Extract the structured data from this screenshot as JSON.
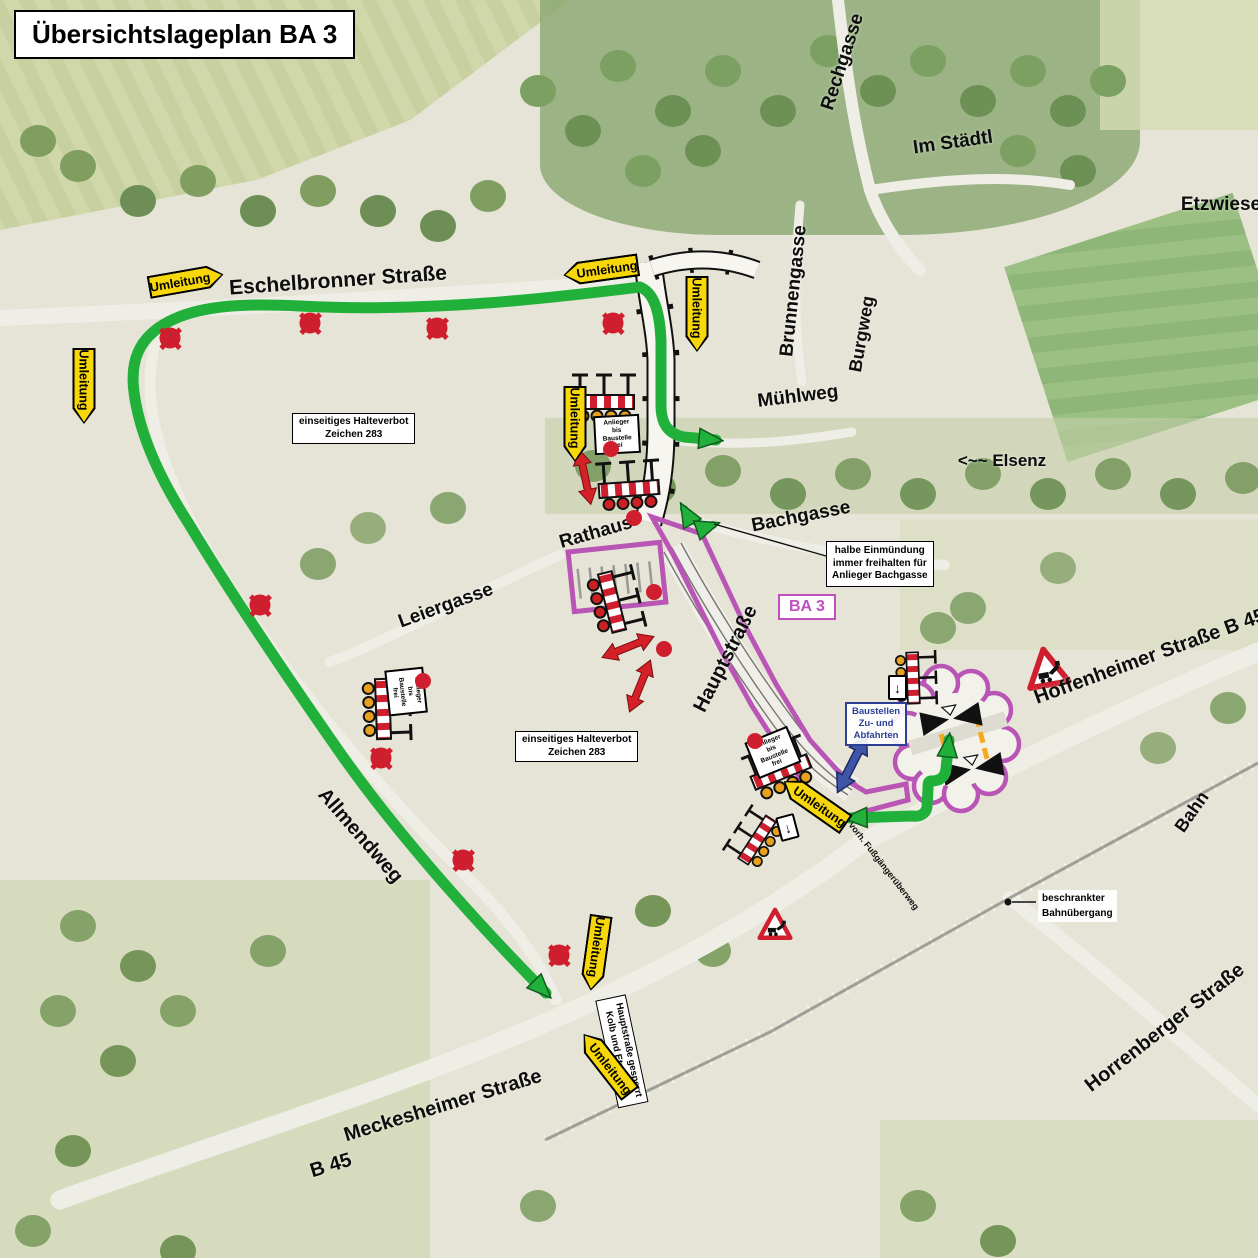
{
  "title": "Übersichtslageplan BA 3",
  "zone_label": "BA 3",
  "colors": {
    "detour_green": "#21b03a",
    "zone_magenta": "#b855b5",
    "sign_yellow": "#f7d60a",
    "warning_red": "#cf1f2e",
    "info_blue": "#2b3f97"
  },
  "street_labels": [
    {
      "id": "eschelbronner-strasse",
      "text": "Eschelbronner Straße",
      "x": 338,
      "y": 281,
      "rot": -4,
      "size": 21
    },
    {
      "id": "rechgasse",
      "text": "Rechgasse",
      "x": 843,
      "y": 62,
      "rot": -72,
      "size": 19
    },
    {
      "id": "im-staedtl",
      "text": "Im Städtl",
      "x": 953,
      "y": 143,
      "rot": -8,
      "size": 19
    },
    {
      "id": "etzwiese",
      "text": "Etzwiese",
      "x": 1221,
      "y": 205,
      "rot": 0,
      "size": 19
    },
    {
      "id": "brunnengasse",
      "text": "Brunnengasse",
      "x": 794,
      "y": 291,
      "rot": -84,
      "size": 19
    },
    {
      "id": "burgweg",
      "text": "Burgweg",
      "x": 862,
      "y": 334,
      "rot": -80,
      "size": 18
    },
    {
      "id": "muehlweg",
      "text": "Mühlweg",
      "x": 798,
      "y": 397,
      "rot": -7,
      "size": 19
    },
    {
      "id": "elsenz",
      "text": "<~~ Elsenz",
      "x": 1002,
      "y": 461,
      "rot": 0,
      "size": 17
    },
    {
      "id": "bachgasse",
      "text": "Bachgasse",
      "x": 801,
      "y": 517,
      "rot": -11,
      "size": 19
    },
    {
      "id": "rathaus",
      "text": "Rathaus",
      "x": 596,
      "y": 533,
      "rot": -16,
      "size": 19
    },
    {
      "id": "leiergasse",
      "text": "Leiergasse",
      "x": 446,
      "y": 606,
      "rot": -20,
      "size": 19
    },
    {
      "id": "hauptstrasse",
      "text": "Hauptstraße",
      "x": 726,
      "y": 659,
      "rot": -63,
      "size": 20
    },
    {
      "id": "hoffenheimer-strasse",
      "text": "Hoffenheimer Straße  B 45",
      "x": 1150,
      "y": 657,
      "rot": -20,
      "size": 20
    },
    {
      "id": "bahn",
      "text": "Bahn",
      "x": 1192,
      "y": 812,
      "rot": -55,
      "size": 18
    },
    {
      "id": "allmendweg",
      "text": "Allmendweg",
      "x": 360,
      "y": 836,
      "rot": 49,
      "size": 20
    },
    {
      "id": "horrenberger-strasse",
      "text": "Horrenberger Straße",
      "x": 1165,
      "y": 1028,
      "rot": -38,
      "size": 20
    },
    {
      "id": "meckesheimer-strasse",
      "text": "Meckesheimer Straße",
      "x": 443,
      "y": 1106,
      "rot": -17,
      "size": 20
    },
    {
      "id": "b45",
      "text": "B 45",
      "x": 331,
      "y": 1166,
      "rot": -17,
      "size": 20
    }
  ],
  "detour_signs": [
    {
      "label": "Umleitung",
      "x": 186,
      "y": 281,
      "rot": -10,
      "dir": "right"
    },
    {
      "label": "Umleitung",
      "x": 84,
      "y": 386,
      "rot": 90,
      "dir": "right"
    },
    {
      "label": "Umleitung",
      "x": 601,
      "y": 270,
      "rot": -8,
      "dir": "left"
    },
    {
      "label": "Umleitung",
      "x": 697,
      "y": 314,
      "rot": 90,
      "dir": "right"
    },
    {
      "label": "Umleitung",
      "x": 575,
      "y": 424,
      "rot": 90,
      "dir": "right"
    },
    {
      "label": "Umleitung",
      "x": 815,
      "y": 803,
      "rot": 35,
      "dir": "left"
    },
    {
      "label": "Umleitung",
      "x": 596,
      "y": 953,
      "rot": 98,
      "dir": "right"
    },
    {
      "label": "Umleitung",
      "x": 607,
      "y": 1064,
      "rot": 52,
      "dir": "left"
    }
  ],
  "info_boxes": {
    "halteverbot_1": {
      "lines": [
        "einseitiges Halteverbot",
        "Zeichen 283"
      ]
    },
    "halteverbot_2": {
      "lines": [
        "einseitiges Halteverbot",
        "Zeichen 283"
      ]
    },
    "einmuendung": {
      "lines": [
        "halbe Einmündung",
        "immer freihalten für",
        "Anlieger Bachgasse"
      ]
    },
    "bahnuebergang": {
      "lines": [
        "beschrankter",
        "Bahnübergang"
      ]
    },
    "baustellen_zufahrt": {
      "lines": [
        "Baustellen",
        "Zu- und",
        "Abfahrten"
      ]
    },
    "gesperrt_sign": {
      "lines": [
        "Hauptstraße gesperrt",
        "Kolb und Etzwiese"
      ]
    },
    "fussgaenger": {
      "text": "vorh. Fußgängerüberweg"
    }
  },
  "small_signs": {
    "anlieger": {
      "lines": [
        "Anlieger",
        "bis Baustelle",
        "frei"
      ]
    },
    "arrow_down": "↓"
  },
  "traffic_symbols": {
    "no_stopping": [
      {
        "x": 170,
        "y": 338
      },
      {
        "x": 310,
        "y": 323
      },
      {
        "x": 437,
        "y": 328
      },
      {
        "x": 613,
        "y": 323
      },
      {
        "x": 260,
        "y": 605
      },
      {
        "x": 381,
        "y": 758
      },
      {
        "x": 463,
        "y": 860
      },
      {
        "x": 559,
        "y": 955
      }
    ],
    "no_entry": [
      {
        "x": 611,
        "y": 449
      },
      {
        "x": 634,
        "y": 518
      },
      {
        "x": 654,
        "y": 592
      },
      {
        "x": 664,
        "y": 649
      },
      {
        "x": 755,
        "y": 741
      },
      {
        "x": 423,
        "y": 681
      }
    ]
  }
}
